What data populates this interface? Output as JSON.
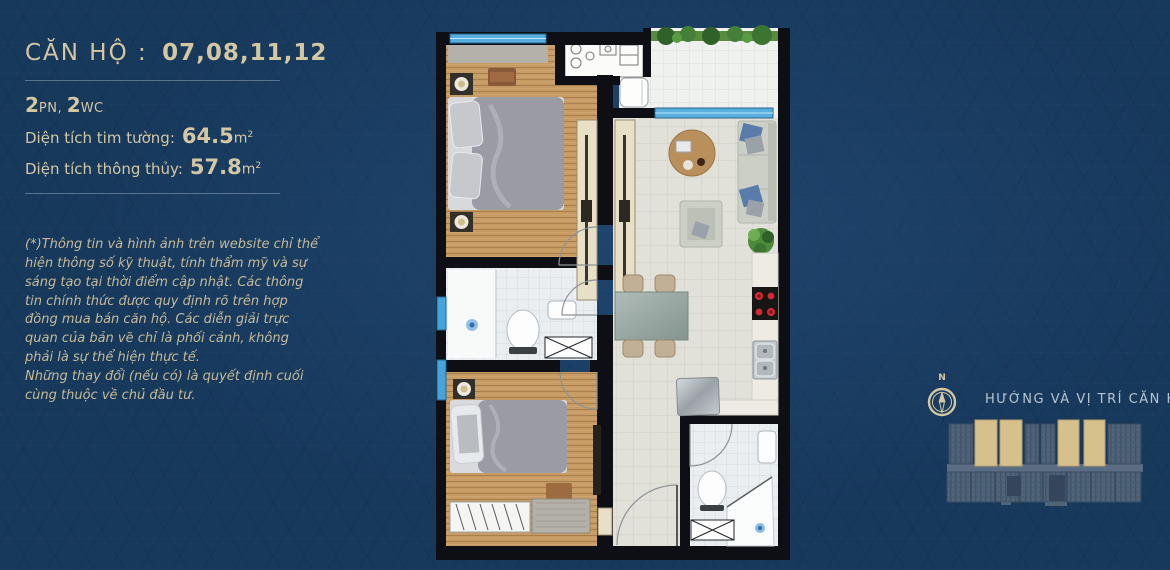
{
  "page": {
    "background": "#17395c",
    "accent": "#d4c7a3"
  },
  "header": {
    "label": "CĂN HỘ :",
    "units": "07,08,11,12"
  },
  "specs": {
    "rooms": [
      {
        "num": "2",
        "unit": "PN, "
      },
      {
        "num": "2",
        "unit": "WC"
      }
    ],
    "areas": [
      {
        "label": "Diện tích tim tường:",
        "value": "64.5",
        "unit": "m",
        "sup": "2"
      },
      {
        "label": "Diện tích thông thủy:",
        "value": "57.8",
        "unit": "m",
        "sup": "2"
      }
    ]
  },
  "disclaimer": {
    "p1": "(*)Thông tin và hình ảnh trên website chỉ thể hiện thông số kỹ thuật, tính thẩm mỹ và sự sáng tạo tại thời điểm cập nhật. Các thông tin chính thức được quy định rõ trên hợp đồng mua bán căn hộ. Các diễn giải trực quan của bản vẽ chỉ là phối cảnh, không phải là sự thể hiện thực tế.",
    "p2": "Những thay đổi (nếu có) là quyết định cuối cùng thuộc về chủ đầu tư."
  },
  "location": {
    "compass_label": "N",
    "heading": "HƯỚNG VÀ VỊ TRÍ CĂN HỘ",
    "highlighted_units": [
      "07",
      "08",
      "11",
      "12"
    ],
    "highlight_color": "#d6c08c",
    "building_color": "#4f6478"
  }
}
